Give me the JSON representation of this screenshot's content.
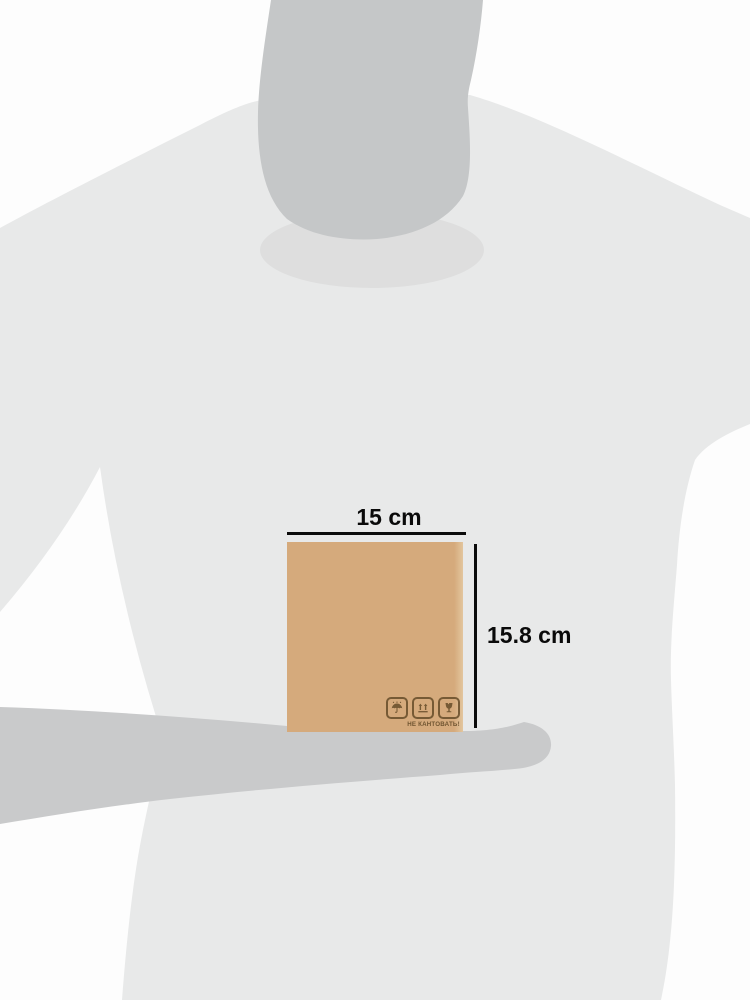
{
  "illustration": {
    "description": "person-silhouette-holding-box-size-reference",
    "dimensions": {
      "width_label": "15 cm",
      "height_label": "15.8 cm"
    },
    "box": {
      "caption": "НЕ КАНТОВАТЬ!",
      "icons": [
        {
          "name": "keep-dry-umbrella-icon"
        },
        {
          "name": "this-way-up-icon"
        },
        {
          "name": "fragile-glass-icon"
        }
      ]
    },
    "colors": {
      "background": "#fdfdfd",
      "tshirt": "#e8e9e9",
      "skin": "#c5c7c8",
      "arm": "#c9cacb",
      "box_fill": "#d5aa7c",
      "box_marking": "#6f5430",
      "dimension": "#0b0b0b"
    }
  }
}
